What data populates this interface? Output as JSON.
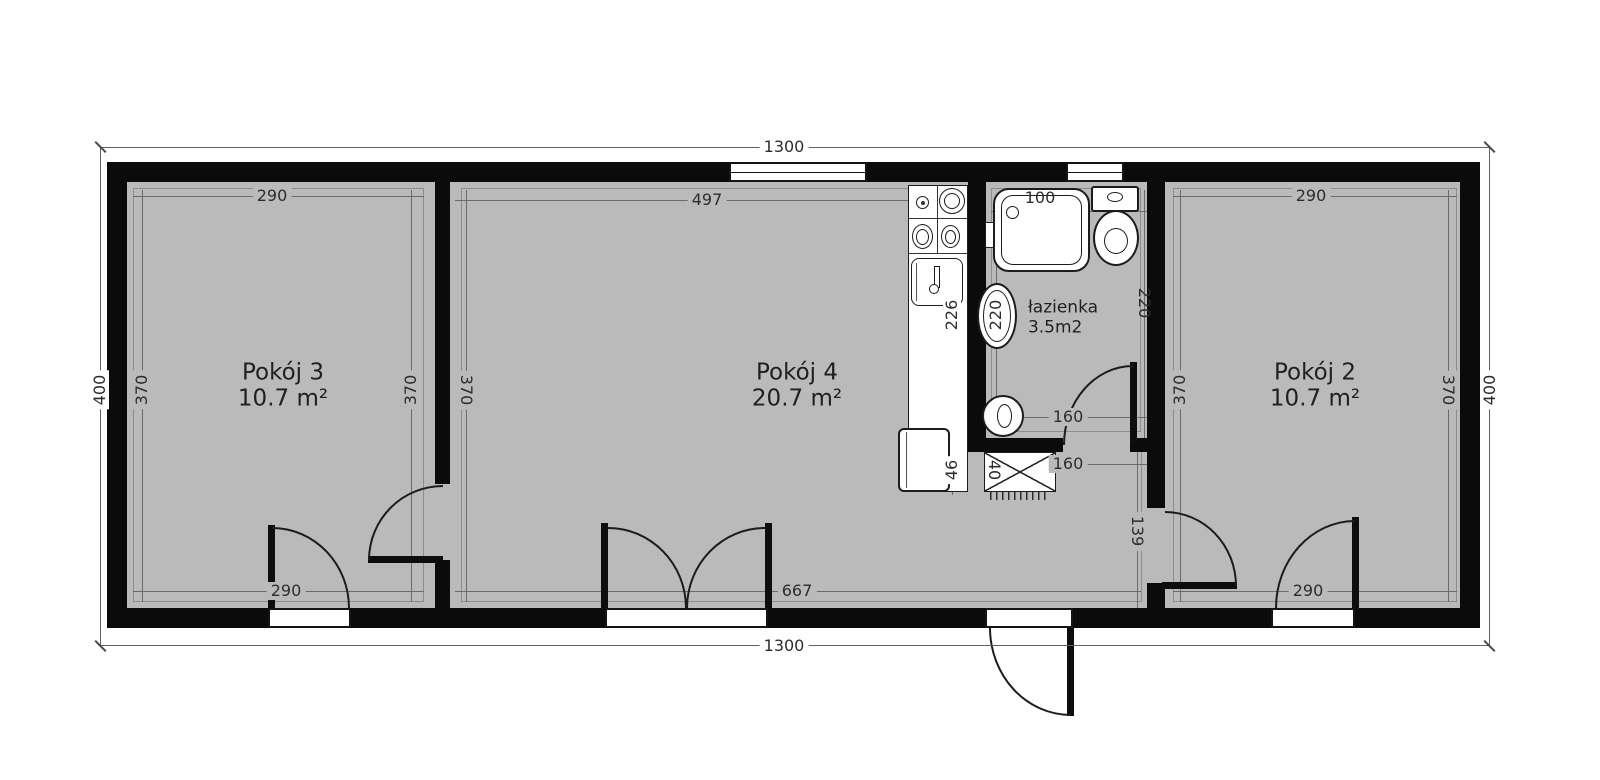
{
  "plan": {
    "title": "floor-plan",
    "colors": {
      "floor": "#bababa",
      "wall": "#0b0b0b",
      "paper": "#ffffff",
      "dim_text": "#2d2d2d"
    },
    "rooms": [
      {
        "name": "Pokój 3",
        "area": "10.7 m²"
      },
      {
        "name": "Pokój 4",
        "area": "20.7 m²"
      },
      {
        "name": "łazienka",
        "area": "3.5m2"
      },
      {
        "name": "Pokój 2",
        "area": "10.7 m²"
      }
    ],
    "dims": {
      "top_overall": "1300",
      "bottom_overall": "1300",
      "left_overall": "400",
      "right_overall": "400",
      "p3_top": "290",
      "p3_left": "370",
      "p3_right": "370",
      "p3_bottom": "290",
      "p4_top": "497",
      "p4_left": "370",
      "p4_bottom": "667",
      "counter_length": "226",
      "counter_depth": "46",
      "bath_top": "100",
      "bath_left": "220",
      "bath_right": "220",
      "bath_width": "160",
      "hall_width": "160",
      "shaft_depth": "40",
      "hall_height": "139",
      "p2_top": "290",
      "p2_left": "370",
      "p2_right": "370",
      "p2_bottom": "290"
    },
    "fixtures": {
      "bathtub": "bathtub",
      "toilet": "toilet",
      "washbasin": "washbasin",
      "washing_machine": "washing-machine",
      "stove": "stove",
      "kitchen_sink": "kitchen-sink",
      "fridge": "fridge",
      "shaft": "shaft"
    }
  }
}
